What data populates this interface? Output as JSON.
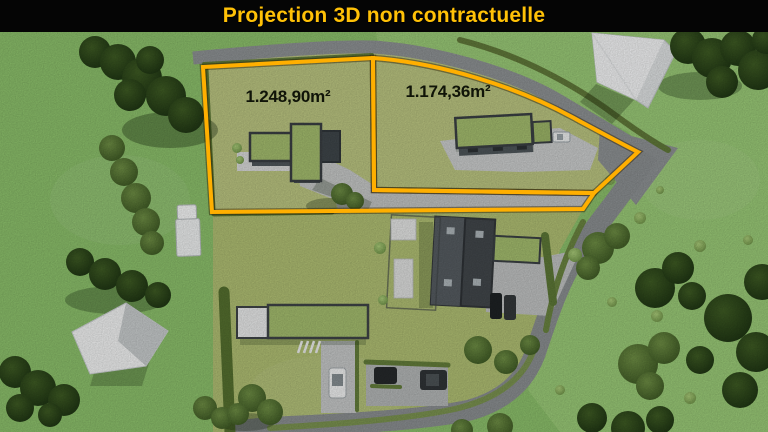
{
  "banner": {
    "title": "Projection 3D non contractuelle",
    "text_color": "#FFC107",
    "background_color": "#050505"
  },
  "scene": {
    "type": "aerial-3d-render",
    "description": "Top-down 3D projection of a property: two building plots outlined in yellow with modern green-roofed houses, an access strip, surrounding roads, hedges, existing houses, parked cars, sheds and trees"
  },
  "parcels": [
    {
      "name": "parcel-1",
      "area_label": "1.248,90m²",
      "outline_points": "203,67 373,58 374,190 594,193 583,209 212,212"
    },
    {
      "name": "parcel-2",
      "area_label": "1.174,36m²",
      "outline_path": "M373,58 C440,63 515,86 572,117 C598,131 622,144 638,152 L594,193 L374,190 Z"
    }
  ],
  "colors": {
    "boundary": "#FFAF00",
    "parcel_grass": "#BBC581",
    "field_grass": "#8CC06B",
    "right_field_grass": "#9ACA77",
    "bottom_property_grass": "#B0BF73",
    "road": "#8E9294",
    "driveway": "#C6C8C7",
    "green_roof": "#A4BD6E",
    "dark_roof": "#42474B",
    "banner_text": "#FFC107"
  }
}
